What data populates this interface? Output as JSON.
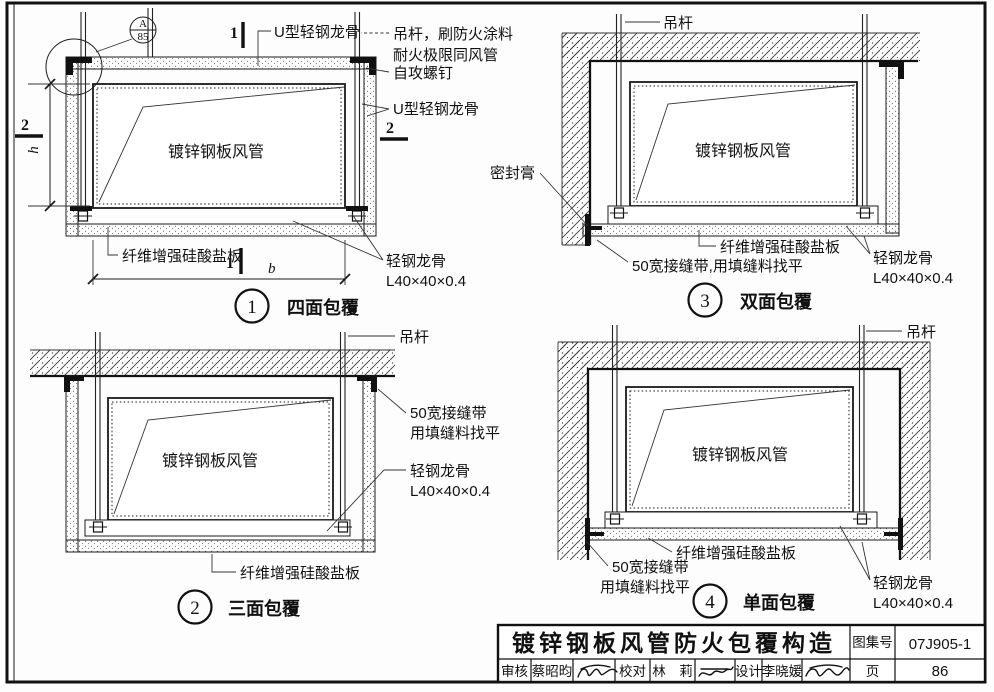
{
  "d1": {
    "number": "1",
    "caption": "四面包覆",
    "callout_letter": "A",
    "callout_page": "85",
    "sec1": "1",
    "sec2": "2",
    "dim_h": "h",
    "dim_b": "b",
    "top_keel": "U型轻钢龙骨",
    "hanger1": "吊杆，刷防火涂料",
    "hanger2": "耐火极限同风管",
    "screw": "自攻螺钉",
    "side_keel": "U型轻钢龙骨",
    "duct": "镀锌钢板风管",
    "board": "纤维增强硅酸盐板",
    "keel1": "轻钢龙骨",
    "keel2": "L40×40×0.4"
  },
  "d2": {
    "number": "2",
    "caption": "三面包覆",
    "hanger": "吊杆",
    "tape1": "50宽接缝带",
    "tape2": "用填缝料找平",
    "keel1": "轻钢龙骨",
    "keel2": "L40×40×0.4",
    "duct": "镀锌钢板风管",
    "board": "纤维增强硅酸盐板"
  },
  "d3": {
    "number": "3",
    "caption": "双面包覆",
    "hanger": "吊杆",
    "sealant": "密封膏",
    "duct": "镀锌钢板风管",
    "board": "纤维增强硅酸盐板",
    "tape": "50宽接缝带,用填缝料找平",
    "keel1": "轻钢龙骨",
    "keel2": "L40×40×0.4"
  },
  "d4": {
    "number": "4",
    "caption": "单面包覆",
    "hanger": "吊杆",
    "duct": "镀锌钢板风管",
    "board": "纤维增强硅酸盐板",
    "tape1": "50宽接缝带",
    "tape2": "用填缝料找平",
    "keel1": "轻钢龙骨",
    "keel2": "L40×40×0.4"
  },
  "tb": {
    "title": "镀锌钢板风管防火包覆构造",
    "atlas_label": "图集号",
    "atlas_no": "07J905-1",
    "page_label": "页",
    "page_no": "86",
    "review_label": "审核",
    "reviewer": "蔡昭昀",
    "proof_label": "校对",
    "proofreader": "林　莉",
    "design_label": "设计",
    "designer": "李晓媛"
  }
}
